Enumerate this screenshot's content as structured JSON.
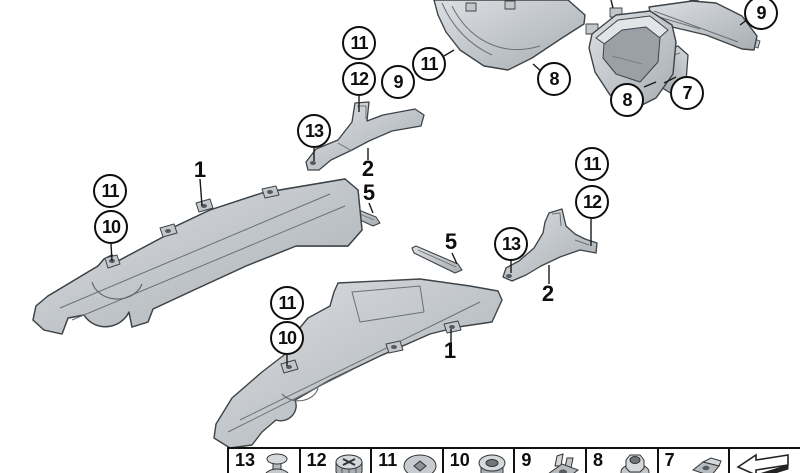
{
  "colors": {
    "background": "#ffffff",
    "outline": "#3e4347",
    "part_fill_light": "#dcdfe2",
    "part_fill_dark": "#a8aeb3",
    "cavity_fill": "#9aa0a6",
    "text": "#0e0e0e"
  },
  "callouts": {
    "circled": [
      {
        "part": "11"
      },
      {
        "part": "12"
      },
      {
        "part": "9"
      },
      {
        "part": "11"
      },
      {
        "part": "13"
      },
      {
        "part": "8"
      },
      {
        "part": "8"
      },
      {
        "part": "7"
      },
      {
        "part": "9"
      },
      {
        "part": "11"
      },
      {
        "part": "10"
      },
      {
        "part": "11"
      },
      {
        "part": "10"
      },
      {
        "part": "11"
      },
      {
        "part": "12"
      },
      {
        "part": "13"
      }
    ],
    "plain": [
      {
        "part": "1"
      },
      {
        "part": "2"
      },
      {
        "part": "5"
      },
      {
        "part": "5"
      },
      {
        "part": "2"
      },
      {
        "part": "1"
      }
    ]
  },
  "legend": {
    "items": [
      {
        "number": "13",
        "icon": "expanding-rivet"
      },
      {
        "number": "12",
        "icon": "screw-grommet"
      },
      {
        "number": "11",
        "icon": "body-clip"
      },
      {
        "number": "10",
        "icon": "grommet"
      },
      {
        "number": "9",
        "icon": "speed-nut"
      },
      {
        "number": "8",
        "icon": "flange-hex-nut"
      },
      {
        "number": "7",
        "icon": "clip-nut"
      },
      {
        "number": "",
        "icon": "direction-arrow"
      }
    ]
  }
}
